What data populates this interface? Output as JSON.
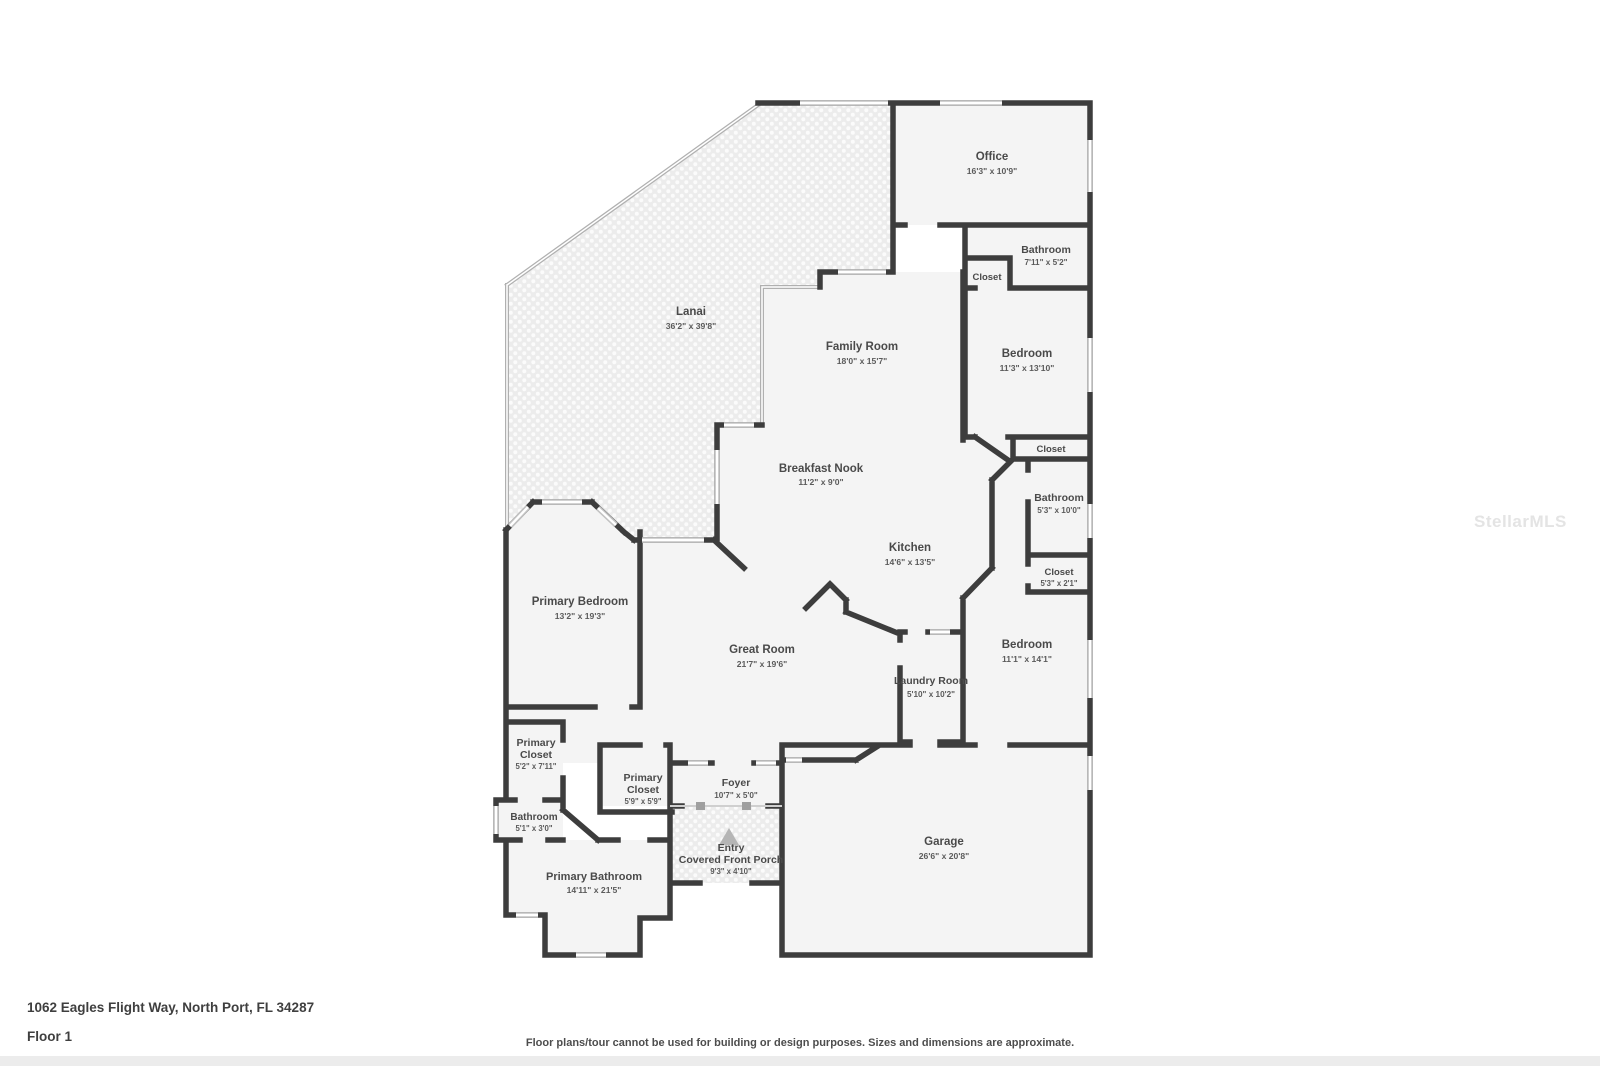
{
  "address": "1062 Eagles Flight Way, North Port, FL 34287",
  "floor_label": "Floor 1",
  "disclaimer": "Floor plans/tour cannot be used for building or design purposes. Sizes and dimensions are approximate.",
  "watermark": "StellarMLS",
  "colors": {
    "wall": "#3d3d3d",
    "room_fill": "#f4f4f4",
    "lanai_fill": "#ececec",
    "window": "#c2c2c2",
    "screen_wall": "#b0b0b0",
    "label_text": "#4a4a4a",
    "entry_marker": "#b5b5b5",
    "watermark_text": "#e4e4e4"
  },
  "rooms": {
    "office": {
      "name": "Office",
      "dims": "16'3\" x 10'9\""
    },
    "bathroom_top": {
      "name": "Bathroom",
      "dims": "7'11\" x 5'2\""
    },
    "closet_top": {
      "name": "Closet"
    },
    "bedroom1": {
      "name": "Bedroom",
      "dims": "11'3\" x 13'10\""
    },
    "closet_mid": {
      "name": "Closet"
    },
    "bathroom_right": {
      "name": "Bathroom",
      "dims": "5'3\" x 10'0\""
    },
    "closet_right": {
      "name": "Closet",
      "dims": "5'3\" x 2'1\""
    },
    "bedroom2": {
      "name": "Bedroom",
      "dims": "11'1\" x 14'1\""
    },
    "lanai": {
      "name": "Lanai",
      "dims": "36'2\" x 39'8\""
    },
    "family_room": {
      "name": "Family Room",
      "dims": "18'0\" x 15'7\""
    },
    "breakfast_nook": {
      "name": "Breakfast Nook",
      "dims": "11'2\" x 9'0\""
    },
    "kitchen": {
      "name": "Kitchen",
      "dims": "14'6\" x 13'5\""
    },
    "primary_bedroom": {
      "name": "Primary Bedroom",
      "dims": "13'2\" x 19'3\""
    },
    "great_room": {
      "name": "Great Room",
      "dims": "21'7\" x 19'6\""
    },
    "laundry": {
      "name": "Laundry Room",
      "dims": "5'10\" x 10'2\""
    },
    "primary_closet1": {
      "line1": "Primary",
      "line2": "Closet",
      "dims": "5'2\" x 7'11\""
    },
    "primary_closet2": {
      "line1": "Primary",
      "line2": "Closet",
      "dims": "5'9\" x 5'9\""
    },
    "foyer": {
      "name": "Foyer",
      "dims": "10'7\" x 5'0\""
    },
    "bathroom_small": {
      "name": "Bathroom",
      "dims": "5'1\" x 3'0\""
    },
    "entry": {
      "line1": "Entry",
      "line2": "Covered Front Porch",
      "dims": "9'3\" x 4'10\""
    },
    "primary_bathroom": {
      "name": "Primary Bathroom",
      "dims": "14'11\" x 21'5\""
    },
    "garage": {
      "name": "Garage",
      "dims": "26'6\" x 20'8\""
    }
  }
}
